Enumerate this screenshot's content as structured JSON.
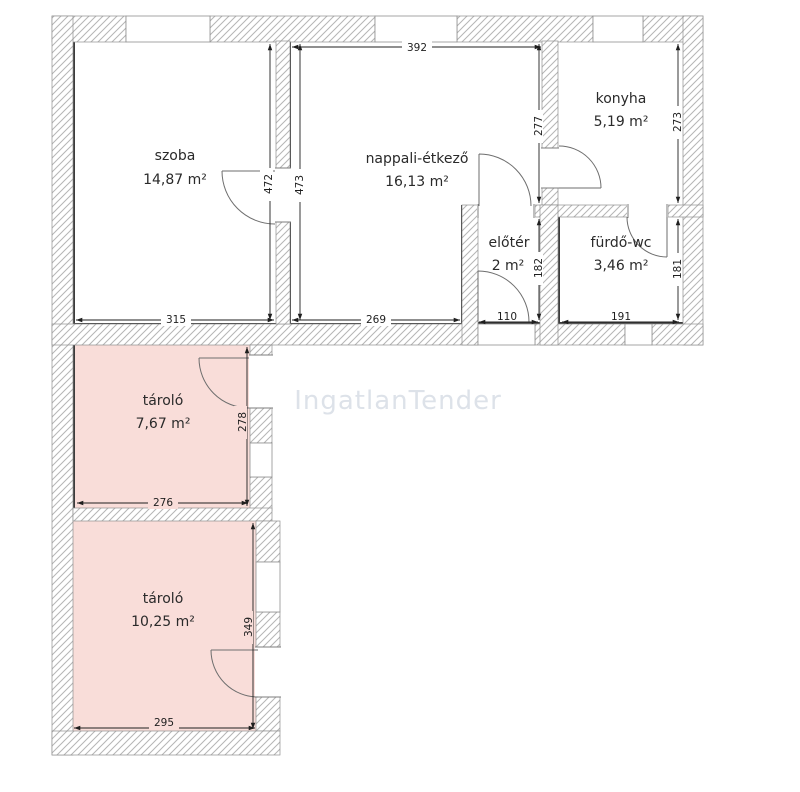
{
  "watermark": "IngatlanTender",
  "rooms": {
    "szoba": {
      "name": "szoba",
      "area": "14,87 m²"
    },
    "nappali": {
      "name": "nappali-étkező",
      "area": "16,13 m²"
    },
    "konyha": {
      "name": "konyha",
      "area": "5,19 m²"
    },
    "eloter": {
      "name": "előtér",
      "area": "2 m²"
    },
    "furdo": {
      "name": "fürdő-wc",
      "area": "3,46 m²"
    },
    "tarolo_felso": {
      "name": "tároló",
      "area": "7,67 m²"
    },
    "tarolo_also": {
      "name": "tároló",
      "area": "10,25 m²"
    }
  },
  "dimensions_cm": {
    "nappali_top": "392",
    "szoba_door_szoba_side": "472",
    "szoba_door_nappali_side": "473",
    "nappali_right": "277",
    "konyha_right": "273",
    "eloter_right": "182",
    "furdo_right": "181",
    "szoba_bottom": "315",
    "nappali_bottom": "269",
    "eloter_bottom": "110",
    "furdo_bottom": "191",
    "tarolo_felso_right": "278",
    "tarolo_felso_bottom": "276",
    "tarolo_also_right": "349",
    "tarolo_also_bottom": "295"
  },
  "colors": {
    "storage_fill": "#f9ddd9",
    "room_fill": "#ffffff",
    "room_border": "#3c3c3c",
    "wall_outline": "#8f8f8f",
    "hatch_line": "#b5b5b5",
    "dimension_text": "#1f1f1f",
    "watermark": "#dde2e9"
  }
}
